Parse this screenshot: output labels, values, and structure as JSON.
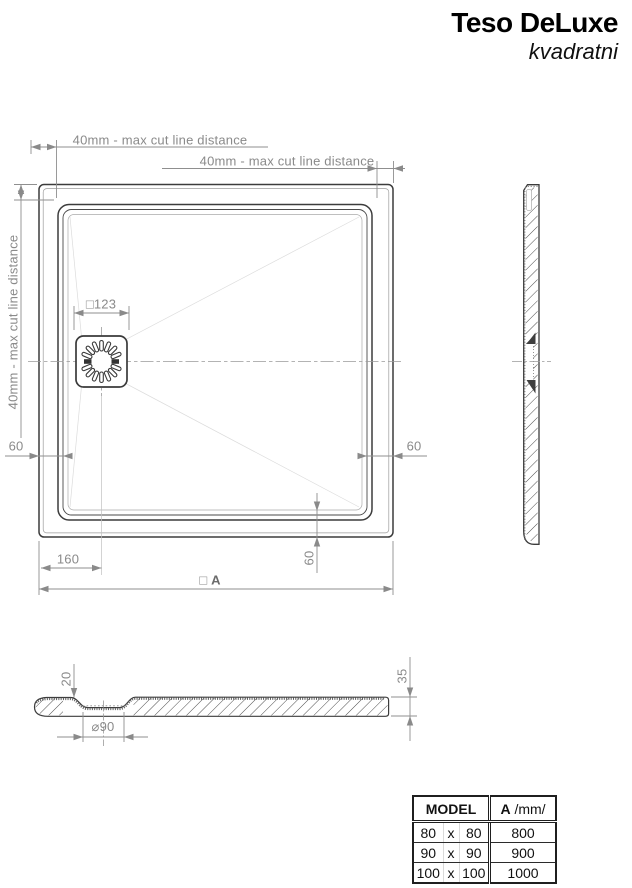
{
  "title": {
    "product": "Teso DeLuxe",
    "variant": "kvadratni"
  },
  "plan": {
    "dim_top_left": "40mm - max cut line distance",
    "dim_top_right": "40mm - max cut line distance",
    "dim_left": "40mm - max cut line distance",
    "dim_drain_flange": "□123",
    "dim_wall_left": "60",
    "dim_wall_right": "60",
    "dim_wall_bottom": "60",
    "dim_drain_offset": "160",
    "dim_overall_symbol": "□",
    "dim_overall": "A"
  },
  "section": {
    "dim_recess_depth": "20",
    "dim_drain_diameter": "⌀90",
    "dim_total_height": "35"
  },
  "table": {
    "header_model": "MODEL",
    "header_a": "A",
    "header_a_unit": " /mm/",
    "rows": [
      {
        "w": "80",
        "sep": "x",
        "h": "80",
        "a": "800"
      },
      {
        "w": "90",
        "sep": "x",
        "h": "90",
        "a": "900"
      },
      {
        "w": "100",
        "sep": "x",
        "h": "100",
        "a": "1000"
      }
    ]
  },
  "colors": {
    "line_dark": "#3c3c3c",
    "dim_gray": "#8a8a8a",
    "cutline_gray": "#c6c6c6",
    "table_border": "#1f1f1f",
    "background": "#ffffff"
  }
}
